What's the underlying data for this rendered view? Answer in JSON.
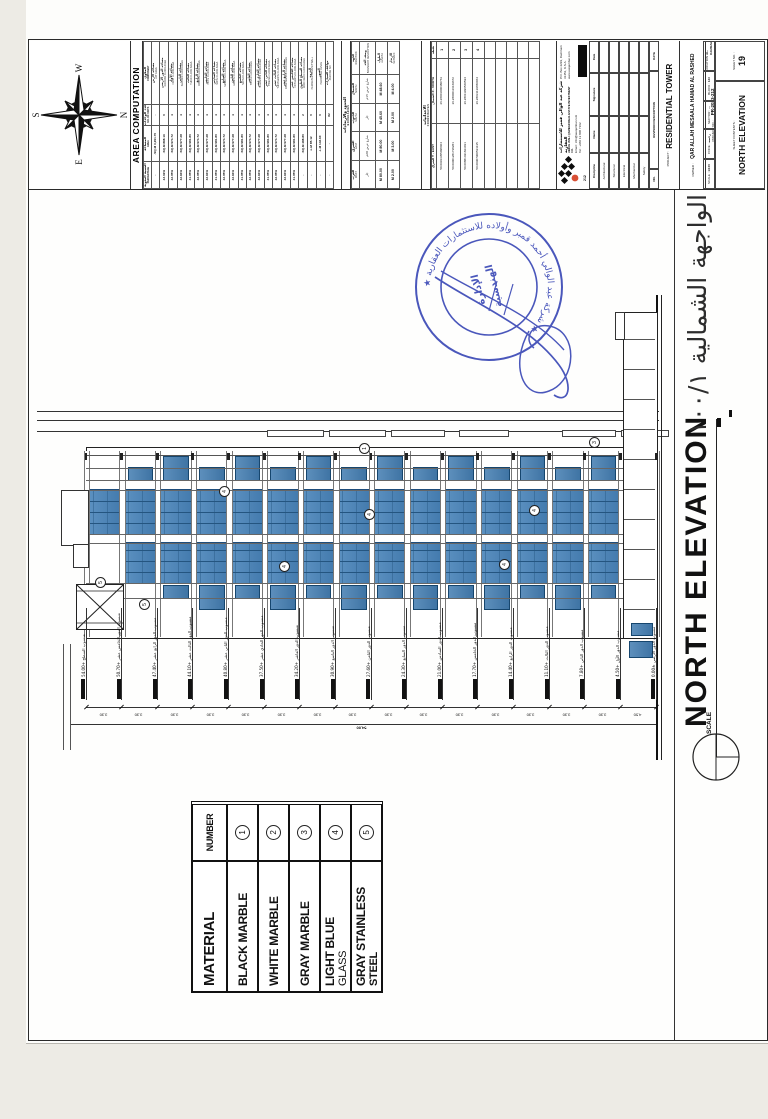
{
  "compass": {
    "top": "S",
    "bottom": "N",
    "left": "E",
    "right": "W"
  },
  "area_table": {
    "title": "AREA COMPUTATION",
    "headers": {
      "component_ar": "المكون",
      "component_en": "COMPONENT",
      "units_ar": "عدد الوحدات",
      "units_en": "NO. OF UNITS",
      "area_ar": "المساحة",
      "area_en": "AREA",
      "pct_ar": "النسبة المئوية",
      "pct_en": "PERCENTAGE"
    },
    "rows": [
      [
        "مساحة الأرض",
        "LOT AREA",
        "-",
        "3,291.70 SQ.M.",
        "-"
      ],
      [
        "مساحة الدور الأرضي",
        "GROUND FLOOR AREA",
        "0",
        "898.16 SQ.M.",
        "43.02%"
      ],
      [
        "مساحة الأول",
        "FIRST FLOOR AREA",
        "4",
        "974.72 SQ.M.",
        "42.05%"
      ],
      [
        "مساحة الثاني",
        "SECOND FLOOR AREA",
        "4",
        "977.28 SQ.M.",
        "42.94%"
      ],
      [
        "مساحة الثالث",
        "THIRD FLOOR AREA",
        "4",
        "981.80 SQ.M.",
        "41.05%"
      ],
      [
        "مساحة الرابع",
        "FOURTH FLOOR AREA",
        "4",
        "974.72 SQ.M.",
        "42.05%"
      ],
      [
        "مساحة الخامس",
        "FIFTH FLOOR AREA",
        "4",
        "977.28 SQ.M.",
        "42.94%"
      ],
      [
        "مساحة السادس",
        "SIXTH FLOOR AREA",
        "4",
        "981.80 SQ.M.",
        "41.05%"
      ],
      [
        "مساحة السابع",
        "SEVENTH FLOOR AREA",
        "4",
        "974.72 SQ.M.",
        "42.05%"
      ],
      [
        "مساحة الثامن",
        "EIGHTH FLOOR AREA",
        "4",
        "977.28 SQ.M.",
        "42.94%"
      ],
      [
        "مساحة التاسع",
        "NINTH FLOOR AREA",
        "4",
        "981.80 SQ.M.",
        "41.05%"
      ],
      [
        "مساحة العاشر",
        "TENTH FLOOR AREA",
        "4",
        "974.72 SQ.M.",
        "42.05%"
      ],
      [
        "مساحة الحادي عشر",
        "ELEVENTH FLOOR AREA",
        "4",
        "977.28 SQ.M.",
        "42.94%"
      ],
      [
        "مساحة الثاني عشر",
        "TWELVE FLOOR AREA",
        "4",
        "981.80 SQ.M.",
        "41.05%"
      ],
      [
        "مساحة الثالث عشر",
        "THIRTEENTH FLOOR AREA",
        "4",
        "974.72 SQ.M.",
        "42.05%"
      ],
      [
        "مساحة الرابع عشر",
        "FOURTEENTH FLOOR AREA",
        "4",
        "977.28 SQ.M.",
        "42.94%"
      ],
      [
        "مساحة الخامس عشر",
        "FIFTEENTH FLOOR AREA",
        "4",
        "981.80 SQ.M.",
        "41.05%"
      ],
      [
        "مساحة السطح العلوي",
        "ROOF DECK FLOOR AREA",
        "2",
        "488.80 SQ.M.",
        "-"
      ],
      [
        "الدروة",
        "PERIMETER PARAPET WALL",
        "0",
        "85.12 L.M.",
        "-"
      ],
      [
        "السور",
        "PERIMETER FENCE",
        "0",
        "146.60 L.M.",
        "-"
      ],
      [
        "مواقف السيارات",
        "PARKING NO.",
        "82",
        "-",
        "-"
      ]
    ]
  },
  "boundary_table": {
    "title_ar": "الحدود والارتدادات",
    "title_en": "BOUNDARIES",
    "row_labels": {
      "dir_ar": "الجهة",
      "dir_en": "DIRECTION",
      "desc_ar": "وصف الحد",
      "desc_en": "BOUNDARY DESCRIPTION",
      "len_ar": "الطول",
      "len_en": "LENGTH",
      "set_ar": "الارتداد",
      "set_en": "SETBACK"
    },
    "directions": [
      {
        "ar": "الشمال",
        "en": "NORTH",
        "desc": "شارع عرض 15م",
        "len": "48.60 M",
        "set": "4.00 M"
      },
      {
        "ar": "الجنوب",
        "en": "SOUTH",
        "desc": "جار",
        "len": "45.60 M",
        "set": "2.00 M"
      },
      {
        "ar": "الشرق",
        "en": "EAST",
        "desc": "شارع عرض 20م",
        "len": "80.00 M",
        "set": "3.00 M"
      },
      {
        "ar": "الغرب",
        "en": "WEST",
        "desc": "جار",
        "len": "80.00 M",
        "set": "2.00 M"
      }
    ]
  },
  "coords_table": {
    "title_ar": "الاحداثيات",
    "title_en": "COORDINATES",
    "point_label": "نقطة",
    "col_x": "X - NORTH الشمال",
    "col_y": "Y - EAST الشرق",
    "points": [
      {
        "n": "1",
        "x": "26.28001000480761",
        "y": "50.09913355098404"
      },
      {
        "n": "2",
        "x": "26.28000116169672",
        "y": "50.09001281738281"
      },
      {
        "n": "3",
        "x": "26.28011996560594",
        "y": "50.00881491823031"
      },
      {
        "n": "4",
        "x": "26.28031139650064",
        "y": "50.00907900531135"
      }
    ]
  },
  "title_block": {
    "company_ar": "شركة عبد الوالي قمبر للاستثمارات العقارية",
    "company_en": "ABDUL WALI QAMBAR REAL ESTATE INVESTMENT CO.",
    "address": "P.O. Box 2293, Dammam 31451, K.S.A.",
    "tel": "Tel : +966 13 808 7162",
    "email": "Email : info@awqambar.com",
    "web": "www.awqambar.com",
    "logo_number": "212",
    "signoff_headers": [
      "Discipline",
      "Name",
      "Signature",
      "Date"
    ],
    "signoff_rows": [
      "Architectural",
      "Structural",
      "Electrical",
      "Mechanical",
      "Safety"
    ],
    "revision_labels": [
      "NO.",
      "REVISION DESCRIPTION",
      "DATE"
    ],
    "project_label": "PROJECT :",
    "project": "RESIDENTIAL TOWER",
    "owner_label": "OWNER :",
    "owner": "QAR ALLAH MESAALA HAMAD AL RASHED",
    "project_no_label": "PROJECT NO. :",
    "project_no": "PR-2023-212",
    "scale_label": "SCALE :",
    "scale": "1/100",
    "code_label": "CODE :",
    "code": "رخصة",
    "sector_label": "SECTOR :",
    "sector": "---",
    "block_label": "BLOCK :",
    "block": "123",
    "location_label": "LOCATION :",
    "location": "AL-DAMMAM",
    "contents_label": "SHEET CONTENTS :",
    "contents": "NORTH ELEVATION",
    "sheet_label": "SHEET NO. :",
    "sheet_no": "19"
  },
  "material_table": {
    "title": "MATERIAL",
    "number_label": "NUMBER",
    "rows": [
      {
        "line1": "BLACK MARBLE",
        "line2": "",
        "num": "1"
      },
      {
        "line1": "WHITE MARBLE",
        "line2": "",
        "num": "2"
      },
      {
        "line1": "GRAY MARBLE",
        "line2": "",
        "num": "3"
      },
      {
        "line1": "LIGHT BLUE",
        "line2": "GLASS",
        "num": "4"
      },
      {
        "line1": "GRAY STAINLESS",
        "line2": "STEEL",
        "num": "5"
      }
    ]
  },
  "elevation": {
    "title": "NORTH ELEVATION",
    "scale_label": "SCALE",
    "arabic_title": "الواجهة الشمالية  ١٠٠/١",
    "levels": [
      "منسوب السطح +54.00",
      "منسوب الدور الخامس عشر +50.70",
      "منسوب الدور الرابع عشر +47.40",
      "منسوب الدور الثالث عشر +44.10",
      "منسوب الدور الثاني عشر +40.80",
      "منسوب الدور الحادي عشر +37.50",
      "منسوب الدور العاشر +34.20",
      "منسوب الدور التاسع +30.90",
      "منسوب الدور الثامن +27.60",
      "منسوب الدور السابع +24.30",
      "منسوب الدور السادس +21.00",
      "منسوب الدور الخامس +17.70",
      "منسوب الدور الرابع +14.40",
      "منسوب الدور الثالث +11.10",
      "منسوب الدور الثاني +7.80",
      "منسوب الدور الأول +4.50",
      "منسوب الدور الأرضي ±0.00"
    ],
    "floor_dims": [
      "3.30",
      "3.30",
      "3.30",
      "3.30",
      "3.30",
      "3.30",
      "3.30",
      "3.30",
      "3.30",
      "3.30",
      "3.30",
      "3.30",
      "3.30",
      "3.30",
      "3.30",
      "4.50"
    ],
    "total_dim": "54.00",
    "tags": [
      "4",
      "4",
      "4",
      "4",
      "4",
      "5",
      "5",
      "1",
      "3"
    ]
  },
  "stamp": {
    "ring_text": "★ شركة عبد الوالي أحمد قمبر وأولاده للاستثمارات العقارية ★",
    "center_line1": "الإدارة",
    "center_line2": "الهندسية"
  },
  "colors": {
    "glass": "#4c82b5",
    "glass_dark": "#1d4d7c",
    "stamp_blue": "#3240b3"
  }
}
